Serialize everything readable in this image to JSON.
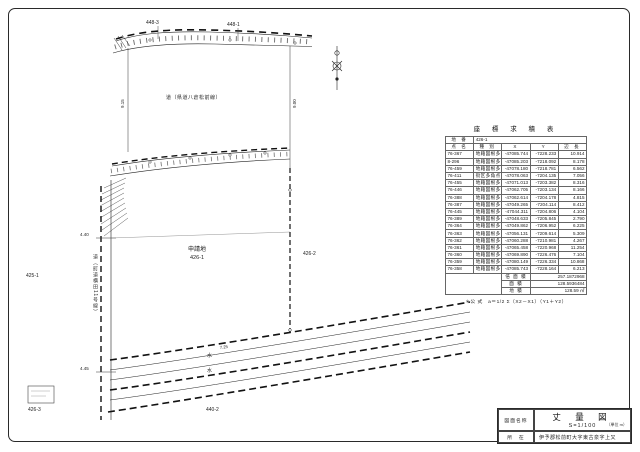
{
  "map": {
    "subject_color": "#c23b3b",
    "labels": {
      "road_top": "道（県道八倉松前線）",
      "road_left": "道（町道横田11号線）",
      "parcel_top_left": "448-3",
      "parcel_top_right": "448-1",
      "parcel_left": "425-1",
      "parcel_right": "426-2",
      "parcel_bottom_left": "426-3",
      "parcel_bottom": "440-2",
      "subject_line1": "申請地",
      "subject_line2": "426-1",
      "water1": "水",
      "water2": "水",
      "dim1": "4.40",
      "dim2": "4.45",
      "dim3": "9.15",
      "dim4": "9.00",
      "dim5": "7.25"
    }
  },
  "table": {
    "title": "座 標 求 積 表",
    "parcel_label": "地 番",
    "parcel_value": "426-1",
    "headers": [
      "点 名",
      "種  別",
      "X",
      "Y",
      "辺 長"
    ],
    "rows": [
      [
        "76-367",
        "地籍図根多角点",
        "-47085.744",
        "-7228.233",
        "10.914"
      ],
      [
        "8-296",
        "地籍図根多角点",
        "-47085.203",
        "-7218.092",
        "8.178"
      ],
      [
        "76-459",
        "地籍図根多角点",
        "-47078.180",
        "-7218.781",
        "6.562"
      ],
      [
        "76-411",
        "街区多角点",
        "-47078.063",
        "-7204.135",
        "7.056"
      ],
      [
        "76-455",
        "地籍図根多角点",
        "-47071.013",
        "-7203.382",
        "8.316"
      ],
      [
        "76-446",
        "地籍図根多角点",
        "-47062.705",
        "-7203.134",
        "8.166"
      ],
      [
        "76-388",
        "地籍図根多角点",
        "-47062.614",
        "-7204.178",
        "4.815"
      ],
      [
        "76-387",
        "地籍図根多角点",
        "-47049.265",
        "-7204.114",
        "8.412"
      ],
      [
        "76-445",
        "地籍図根多角点",
        "-47044.311",
        "-7204.806",
        "4.104"
      ],
      [
        "76-389",
        "地籍図根多角点",
        "-47048.633",
        "-7205.845",
        "2.790"
      ],
      [
        "76-364",
        "地籍図根多角点",
        "-47049.862",
        "-7206.952",
        "6.225"
      ],
      [
        "76-363",
        "地籍図根多角点",
        "-47056.131",
        "-7209.614",
        "5.309"
      ],
      [
        "76-362",
        "地籍図根多角点",
        "-47060.288",
        "-7210.981",
        "4.267"
      ],
      [
        "76-361",
        "地籍図根多角点",
        "-47065.458",
        "-7220.968",
        "11.254"
      ],
      [
        "76-360",
        "地籍図根多角点",
        "-47069.890",
        "-7226.476",
        "7.104"
      ],
      [
        "76-359",
        "地籍図根多角点",
        "-47080.149",
        "-7226.334",
        "10.868"
      ],
      [
        "76-358",
        "地籍図根多角点",
        "-47085.743",
        "-7228.164",
        "6.213"
      ]
    ],
    "summary": [
      [
        "倍 面 積",
        "257.1872968"
      ],
      [
        "面  積",
        "128.5936484"
      ],
      [
        "地  積",
        "128.59 ㎡"
      ]
    ],
    "formula": "＊公 式　a＝1/2 Σ（X2－X1）（Y1＋Y2）"
  },
  "titleblock": {
    "name_label": "図面名称",
    "name_value": "丈 量 図",
    "scale": "S=1/100",
    "unit": "（単位 m）",
    "location_label": "所　在",
    "location_value": "伊予郡松前町大字東古泉字上又"
  }
}
